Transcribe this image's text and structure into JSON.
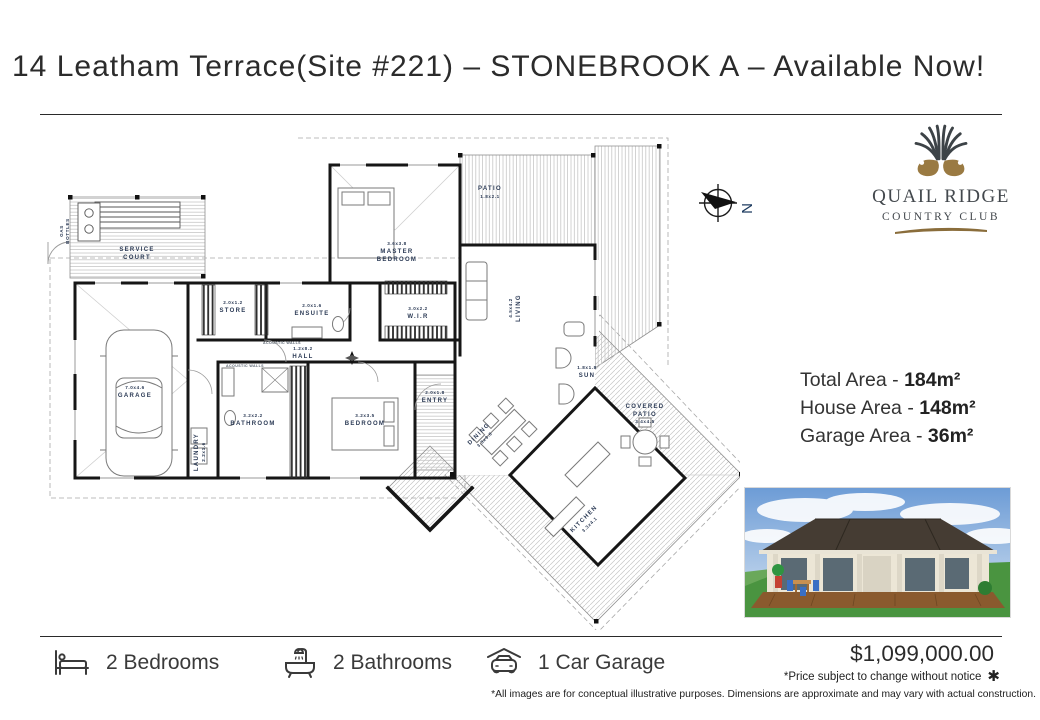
{
  "title": "14 Leatham Terrace(Site #221) – STONEBROOK A – Available Now!",
  "logo": {
    "name": "QUAIL RIDGE",
    "tagline": "COUNTRY CLUB"
  },
  "compass": {
    "label": "N"
  },
  "area_summary": {
    "rows": [
      {
        "label": "Total Area - ",
        "value": "184m²"
      },
      {
        "label": "House Area - ",
        "value": "148m²"
      },
      {
        "label": "Garage Area - ",
        "value": "36m²"
      }
    ]
  },
  "floorplan": {
    "rooms": {
      "service_court": {
        "name1": "SERVICE",
        "name2": "COURT"
      },
      "gas_bottles": {
        "name1": "GAS",
        "name2": "BOTTLES"
      },
      "garage": {
        "dims": "7.0x4.6",
        "name": "GARAGE"
      },
      "store": {
        "dims": "2.0x1.2",
        "name": "STORE"
      },
      "ensuite": {
        "dims": "2.0x1.6",
        "name": "ENSUITE"
      },
      "hall": {
        "dims": "1.2x8.2",
        "name": "HALL"
      },
      "master_bedroom": {
        "dims": "3.6x3.8",
        "name1": "MASTER",
        "name2": "BEDROOM"
      },
      "wir": {
        "dims": "3.0x2.2",
        "name": "W.I.R"
      },
      "patio": {
        "name": "PATIO",
        "dims": "1.8x2.1"
      },
      "living": {
        "dims": "4.5x4.2",
        "name": "LIVING"
      },
      "laundry": {
        "name": "LAUNDRY",
        "dims": "2.2x1.6"
      },
      "bathroom": {
        "dims": "3.2x2.2",
        "name": "BATHROOM"
      },
      "bedroom": {
        "dims": "3.2x3.5",
        "name": "BEDROOM"
      },
      "entry": {
        "dims": "2.0x1.8",
        "name": "ENTRY"
      },
      "dining": {
        "name": "DINING",
        "dims": "3.3x3.0"
      },
      "kitchen": {
        "name": "KITCHEN",
        "dims": "3.3x4.1"
      },
      "covered_patio": {
        "name1": "COVERED",
        "name2": "PATIO",
        "dims": "3.4x4.5"
      },
      "sun": {
        "dims": "1.8x1.8",
        "name": "SUN"
      },
      "acoustic": {
        "name": "ACOUSTIC WALLS"
      }
    }
  },
  "footer": {
    "features": [
      {
        "icon": "bed-icon",
        "label": "2 Bedrooms"
      },
      {
        "icon": "bath-icon",
        "label": "2 Bathrooms"
      },
      {
        "icon": "car-garage-icon",
        "label": "1 Car Garage"
      }
    ],
    "price": "$1,099,000.00",
    "price_note": "*Price subject to change without notice",
    "price_note_mark": "✱",
    "disclaimer": "*All images are for conceptual illustrative purposes. Dimensions are approximate and may vary with actual construction."
  },
  "colors": {
    "accent_brown": "#8a6d3b",
    "logo_slate": "#43484d",
    "plan_label_navy": "#2b3a55"
  }
}
